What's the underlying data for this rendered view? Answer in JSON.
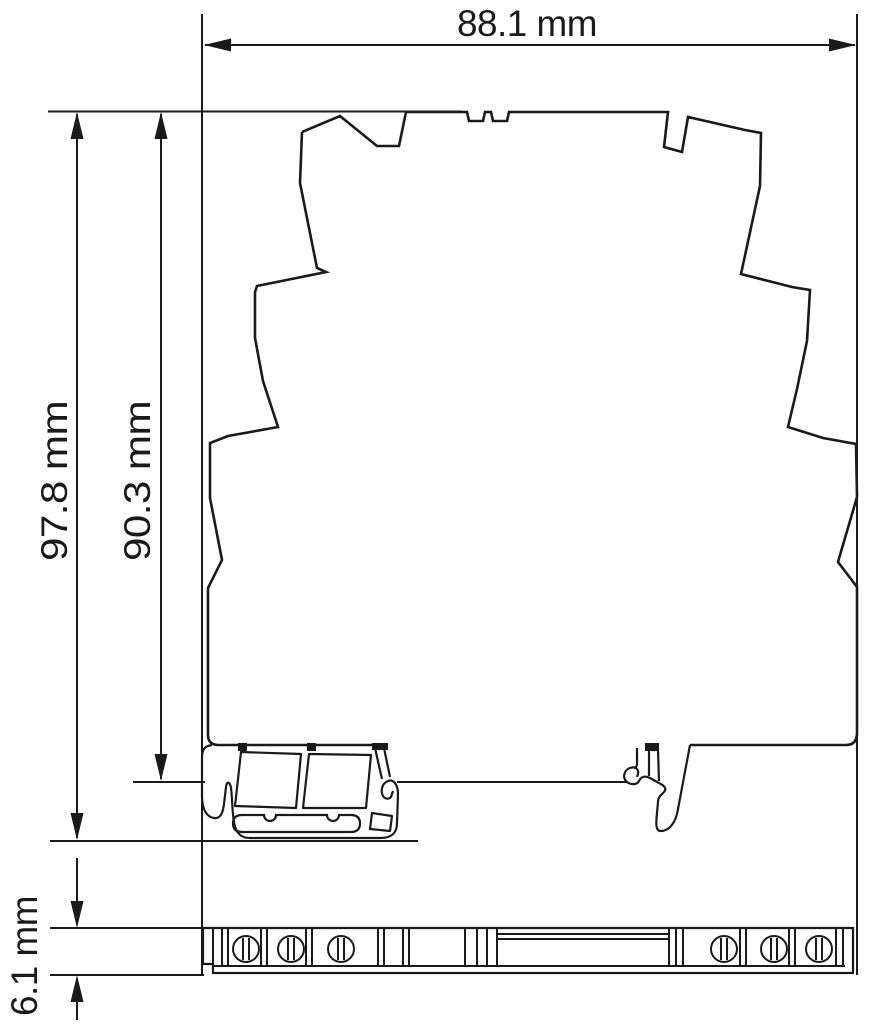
{
  "drawing": {
    "type": "technical dimensional drawing (DIN-rail module side view)",
    "units": "mm",
    "background_color": "#ffffff",
    "line_color": "#1a1a1a",
    "dimensions": {
      "width": {
        "label": "88.1 mm",
        "value": 88.1
      },
      "total_height": {
        "label": "97.8 mm",
        "value": 97.8
      },
      "height_to_rail_surface": {
        "label": "90.3 mm",
        "value": 90.3
      },
      "rail_channel_depth": {
        "label": "6.1 mm",
        "value": 6.1
      }
    }
  }
}
